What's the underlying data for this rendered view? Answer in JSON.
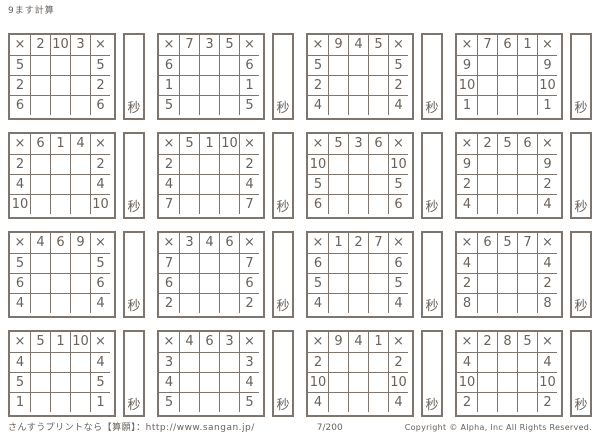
{
  "page_title": "9ます計算",
  "symbols": {
    "multiply": "×",
    "seconds": "秒"
  },
  "colors": {
    "ink": "#6a625b",
    "line": "#7e766e",
    "background": "#ffffff"
  },
  "footer": {
    "left": "さんすうプリントなら【算願】：http://www.sangan.jp/",
    "center": "7/200",
    "right": "Copyright © Alpha, Inc All Rights Reserved."
  },
  "grids": [
    {
      "top": [
        "2",
        "10",
        "3"
      ],
      "left": [
        "5",
        "2",
        "6"
      ]
    },
    {
      "top": [
        "7",
        "3",
        "5"
      ],
      "left": [
        "6",
        "1",
        "5"
      ]
    },
    {
      "top": [
        "9",
        "4",
        "5"
      ],
      "left": [
        "5",
        "2",
        "4"
      ]
    },
    {
      "top": [
        "7",
        "6",
        "1"
      ],
      "left": [
        "9",
        "10",
        "1"
      ]
    },
    {
      "top": [
        "6",
        "1",
        "4"
      ],
      "left": [
        "2",
        "4",
        "10"
      ]
    },
    {
      "top": [
        "5",
        "1",
        "10"
      ],
      "left": [
        "2",
        "4",
        "7"
      ]
    },
    {
      "top": [
        "5",
        "3",
        "6"
      ],
      "left": [
        "10",
        "5",
        "6"
      ]
    },
    {
      "top": [
        "2",
        "5",
        "6"
      ],
      "left": [
        "9",
        "2",
        "4"
      ]
    },
    {
      "top": [
        "4",
        "6",
        "9"
      ],
      "left": [
        "5",
        "6",
        "4"
      ]
    },
    {
      "top": [
        "3",
        "4",
        "6"
      ],
      "left": [
        "7",
        "6",
        "2"
      ]
    },
    {
      "top": [
        "1",
        "2",
        "7"
      ],
      "left": [
        "6",
        "5",
        "4"
      ]
    },
    {
      "top": [
        "6",
        "5",
        "7"
      ],
      "left": [
        "4",
        "2",
        "8"
      ]
    },
    {
      "top": [
        "5",
        "1",
        "10"
      ],
      "left": [
        "4",
        "5",
        "1"
      ]
    },
    {
      "top": [
        "4",
        "6",
        "3"
      ],
      "left": [
        "3",
        "4",
        "5"
      ]
    },
    {
      "top": [
        "9",
        "4",
        "1"
      ],
      "left": [
        "2",
        "10",
        "4"
      ]
    },
    {
      "top": [
        "2",
        "8",
        "5"
      ],
      "left": [
        "4",
        "10",
        "2"
      ]
    }
  ]
}
